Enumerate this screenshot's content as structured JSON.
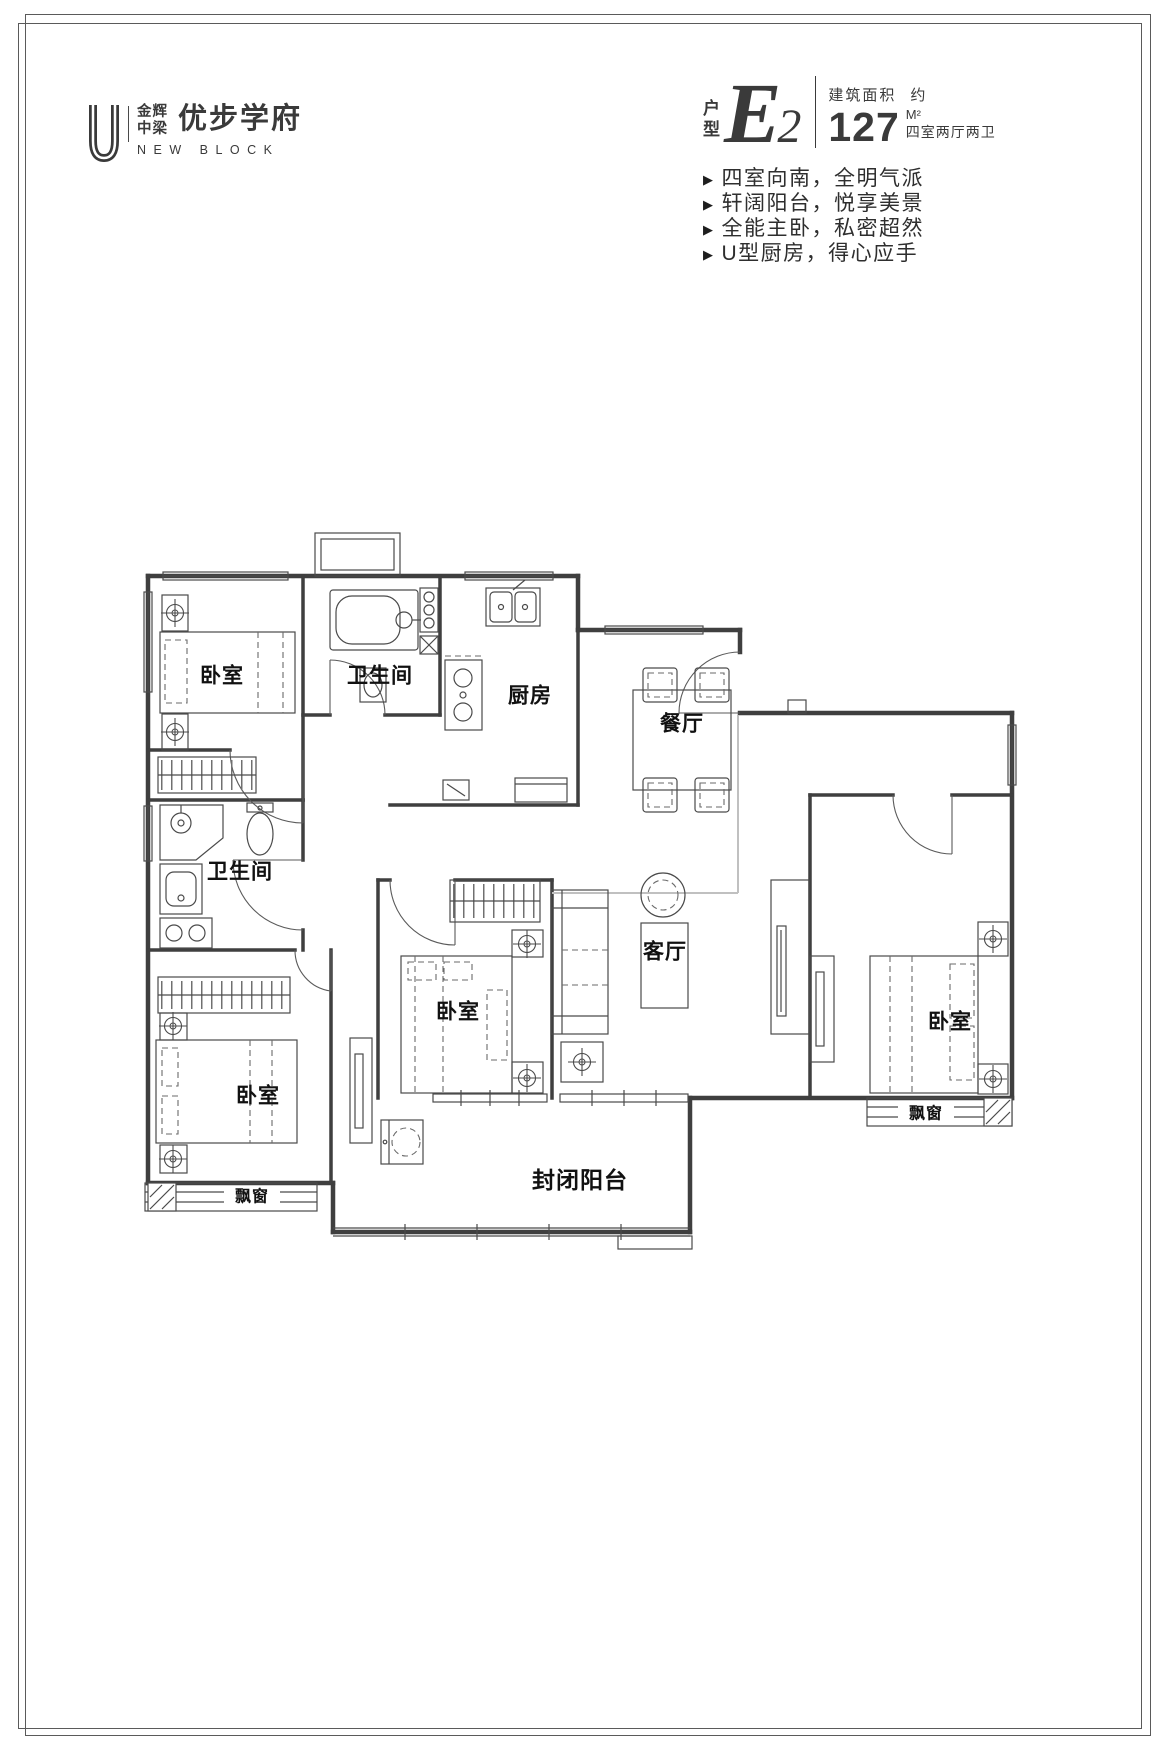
{
  "logo": {
    "mark": "U",
    "brand_top": "金辉",
    "brand_bottom": "中梁",
    "name": "优步学府",
    "subtitle": "NEW BLOCK"
  },
  "unit": {
    "type_label_top": "户",
    "type_label_bottom": "型",
    "type_letter": "E",
    "type_number": "2",
    "area_title": "建筑面积",
    "area_approx": "约",
    "area_value": "127",
    "area_unit": "M²",
    "layout_summary": "四室两厅两卫"
  },
  "features": {
    "marker": "▶",
    "items": [
      "四室向南，全明气派",
      "轩阔阳台，悦享美景",
      "全能主卧，私密超然",
      "U型厨房，得心应手"
    ]
  },
  "floorplan": {
    "labels": {
      "bedroom_top_left": "卧室",
      "bathroom_top": "卫生间",
      "kitchen": "厨房",
      "dining": "餐厅",
      "bathroom_mid": "卫生间",
      "bedroom_mid": "卧室",
      "living": "客厅",
      "bedroom_right": "卧室",
      "bedroom_bottom_left": "卧室",
      "balcony": "封闭阳台",
      "bay_window_left": "飘窗",
      "bay_window_right": "飘窗"
    }
  },
  "colors": {
    "ink": "#3a3a3a",
    "wall": "#3f3f3f",
    "furniture": "#4a4a4a",
    "light_line": "#c0c0c0"
  }
}
